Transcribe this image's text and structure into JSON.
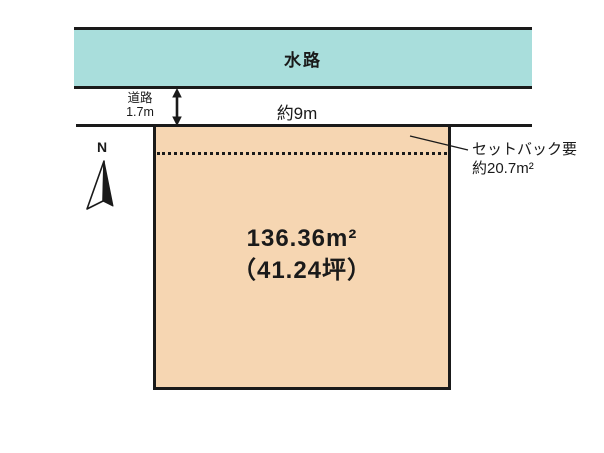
{
  "plan": {
    "waterway_label": "水路",
    "road_label_line1": "道路",
    "road_label_line2": "1.7m",
    "frontage_label": "約9m",
    "setback_line1": "セットバック要",
    "setback_line2": "約20.7m²",
    "area_m2": "136.36m²",
    "area_tsubo": "（41.24坪）",
    "north_label": "N",
    "colors": {
      "waterway_fill": "#a9dedc",
      "parcel_fill": "#f6d6b2",
      "line": "#1a1a1a"
    }
  }
}
